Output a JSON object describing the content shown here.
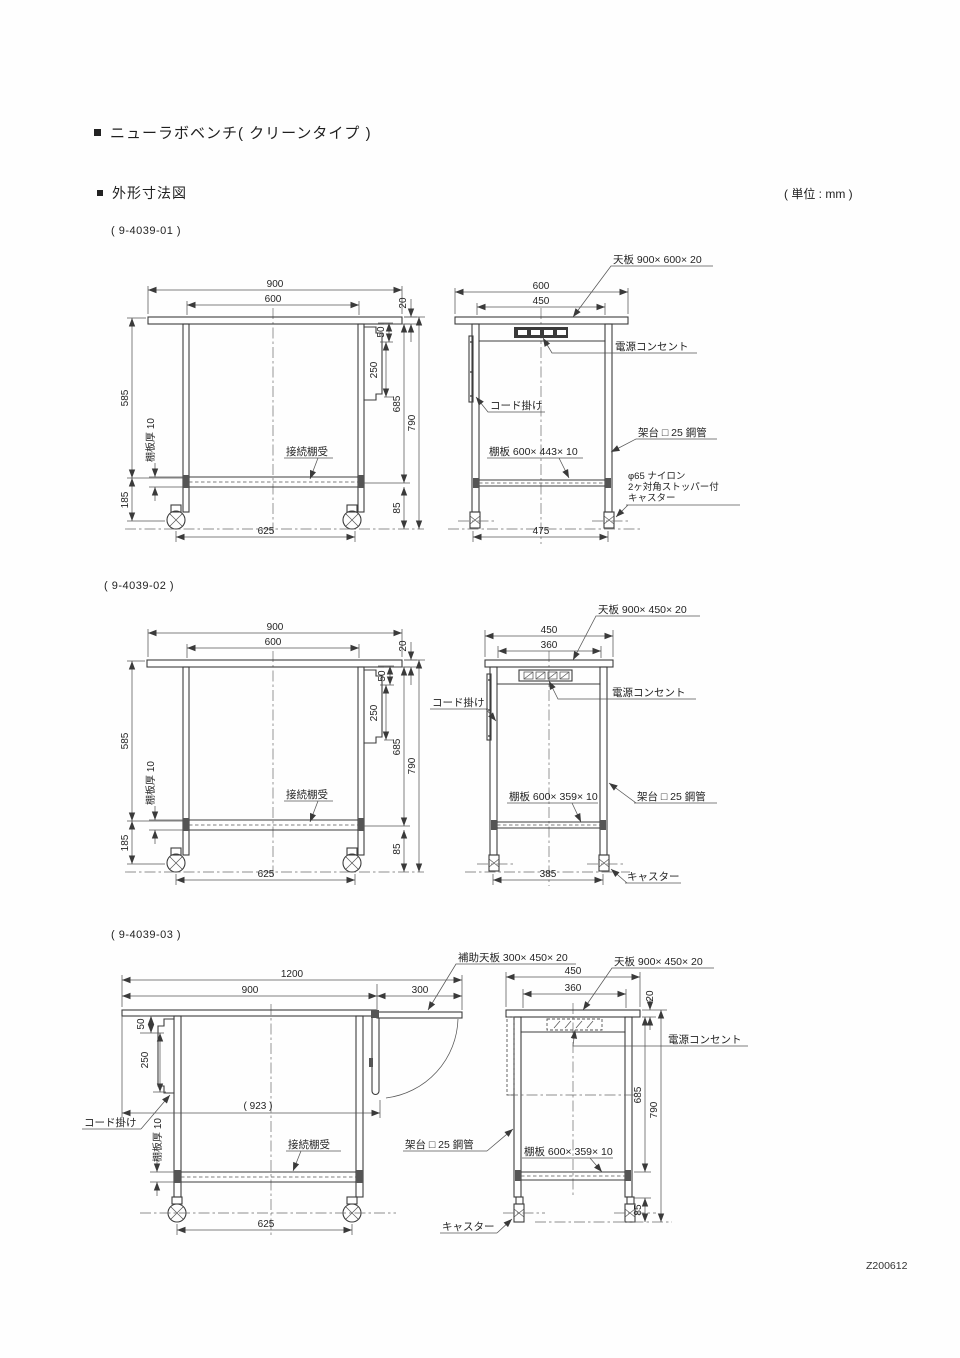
{
  "header": {
    "bullet": "■",
    "title": "ニューラボベンチ( クリーンタイプ )",
    "section": "外形寸法図",
    "unit": "( 単位 : mm )",
    "code": "Z200612"
  },
  "d1": {
    "id": "( 9-4039-01 )",
    "front": {
      "w900": "900",
      "w600": "600",
      "t20": "20",
      "hook50": "50",
      "hook250": "250",
      "h585": "585",
      "shelf_t": "棚板厚 10",
      "h185": "185",
      "h685": "685",
      "h790": "790",
      "h85": "85",
      "span625": "625",
      "bracket": "接続棚受"
    },
    "side": {
      "top_plate": "天板 900× 600× 20",
      "d600": "600",
      "d450": "450",
      "outlet": "電源コンセント",
      "hook": "コード掛け",
      "frame": "架台 □ 25 鋼管",
      "shelf": "棚板 600× 443× 10",
      "cast1": "φ65 ナイロン",
      "cast2": "2ヶ対角ストッパー付",
      "cast3": "キャスター",
      "span475": "475"
    }
  },
  "d2": {
    "id": "( 9-4039-02 )",
    "front": {
      "w900": "900",
      "w600": "600",
      "t20": "20",
      "hook50": "50",
      "hook250": "250",
      "h585": "585",
      "shelf_t": "棚板厚 10",
      "h185": "185",
      "h685": "685",
      "h790": "790",
      "h85": "85",
      "span625": "625",
      "bracket": "接続棚受"
    },
    "side": {
      "top_plate": "天板 900× 450× 20",
      "d450": "450",
      "d360": "360",
      "outlet": "電源コンセント",
      "hook": "コード掛け",
      "frame": "架台 □ 25 鋼管",
      "shelf": "棚板 600× 359× 10",
      "caster": "キャスター",
      "span385": "385"
    }
  },
  "d3": {
    "id": "( 9-4039-03 )",
    "front": {
      "w1200": "1200",
      "w900": "900",
      "w300": "300",
      "aux": "補助天板 300× 450× 20",
      "hook50": "50",
      "hook250": "250",
      "hook": "コード掛け",
      "span923": "( 923 )",
      "shelf_t": "棚板厚 10",
      "bracket": "接続棚受",
      "span625": "625",
      "frame": "架台 □ 25 鋼管",
      "caster": "キャスター"
    },
    "side": {
      "top_plate": "天板 900× 450× 20",
      "d450": "450",
      "d360": "360",
      "t20": "20",
      "outlet": "電源コンセント",
      "h685": "685",
      "h790": "790",
      "shelf": "棚板 600× 359× 10",
      "h85": "85"
    }
  }
}
